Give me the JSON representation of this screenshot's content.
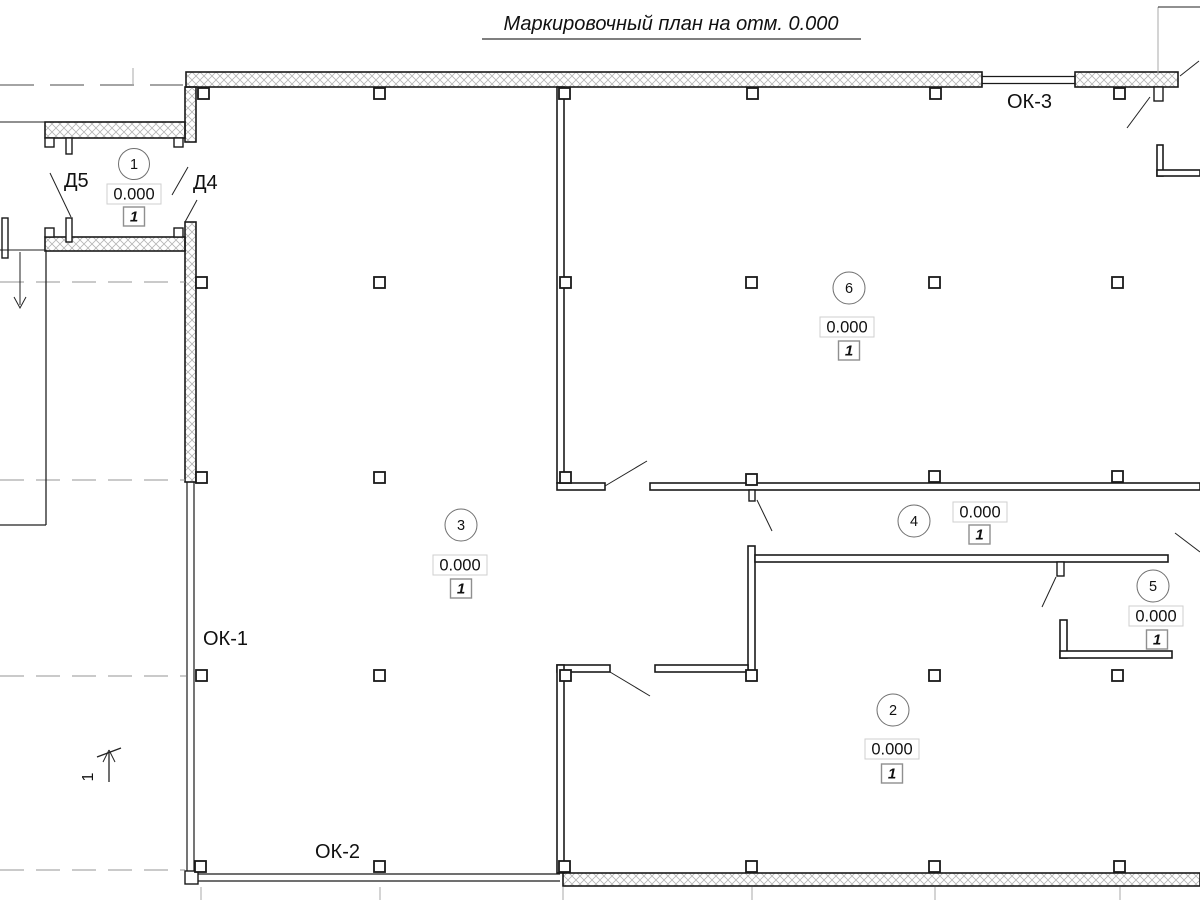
{
  "title": "Маркировочный план на отм. 0.000",
  "section": {
    "label": "1"
  },
  "windows": {
    "ok1": "ОК-1",
    "ok2": "ОК-2",
    "ok3": "ОК-3"
  },
  "doors": {
    "d4": "Д4",
    "d5": "Д5"
  },
  "rooms": [
    {
      "number": "1",
      "elevation": "0.000",
      "finish": "1"
    },
    {
      "number": "2",
      "elevation": "0.000",
      "finish": "1"
    },
    {
      "number": "3",
      "elevation": "0.000",
      "finish": "1"
    },
    {
      "number": "4",
      "elevation": "0.000",
      "finish": "1"
    },
    {
      "number": "5",
      "elevation": "0.000",
      "finish": "1"
    },
    {
      "number": "6",
      "elevation": "0.000",
      "finish": "1"
    }
  ]
}
